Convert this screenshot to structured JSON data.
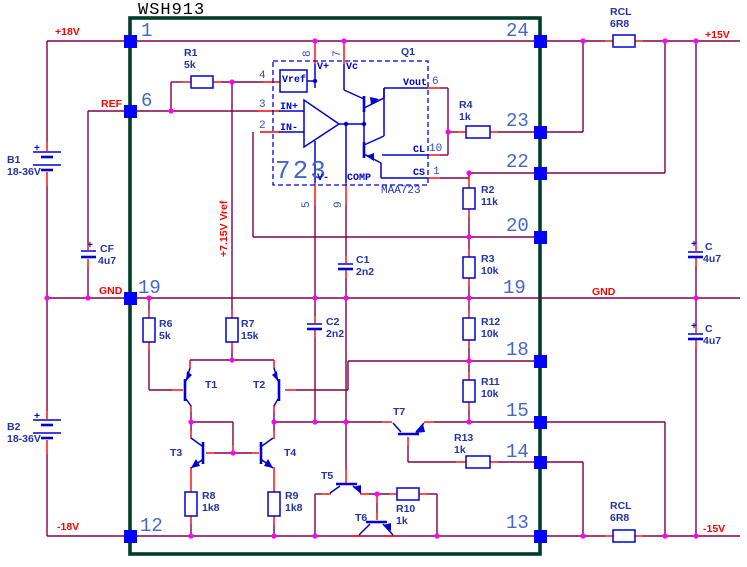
{
  "palette": {
    "wire": "#800045",
    "pin_wire": "#FF0000",
    "symbol_blue": "#0000D2",
    "pad_blue": "#0000FF",
    "junction_magenta": "#FF00FF",
    "module_border_green": "#003C28",
    "pin_number_blue": "#4466CC",
    "label_blue": "#2233AA",
    "net_label_red": "#FF0000",
    "title_black": "#000000",
    "background": "#FFFFFF"
  },
  "title": "WSH913",
  "module": {
    "pins_left": [
      "1",
      "6",
      "19",
      "12"
    ],
    "pins_right": [
      "24",
      "23",
      "22",
      "20",
      "19",
      "18",
      "15",
      "14",
      "13"
    ]
  },
  "nets": {
    "plus18": "+18V",
    "ref": "REF",
    "gnd_left": "GND",
    "minus18": "-18V",
    "plus15": "+15V",
    "gnd_right": "GND",
    "minus15": "-15V",
    "vref_rail": "+7.15V Vref"
  },
  "ic": {
    "designator": "Q1",
    "number": "723",
    "part": "MAA723",
    "terminals": {
      "vref": "Vref",
      "vplus": "V+",
      "vc": "Vc",
      "in_plus": "IN+",
      "in_minus": "IN-",
      "vout": "Vout",
      "cl": "CL",
      "cs": "CS",
      "vminus": "V-",
      "comp": "COMP"
    },
    "pin_numbers": {
      "n8": "8",
      "n7": "7",
      "n4": "4",
      "n3": "3",
      "n2": "2",
      "n6": "6",
      "n10": "10",
      "n1": "1",
      "n5": "5",
      "n9": "9"
    }
  },
  "components": {
    "b1": {
      "ref": "B1",
      "value": "18-36V",
      "plus": "+"
    },
    "b2": {
      "ref": "B2",
      "value": "18-36V",
      "plus": "+"
    },
    "cf": {
      "ref": "CF",
      "value": "4u7",
      "plus": "+"
    },
    "c_out_top": {
      "ref": "C",
      "value": "4u7",
      "plus": "+"
    },
    "c_out_bottom": {
      "ref": "C",
      "value": "4u7",
      "plus": "+"
    },
    "rcl_top": {
      "ref": "RCL",
      "value": "6R8"
    },
    "rcl_bottom": {
      "ref": "RCL",
      "value": "6R8"
    },
    "r1": {
      "ref": "R1",
      "value": "5k"
    },
    "r2": {
      "ref": "R2",
      "value": "11k"
    },
    "r3": {
      "ref": "R3",
      "value": "10k"
    },
    "r4": {
      "ref": "R4",
      "value": "1k"
    },
    "r6": {
      "ref": "R6",
      "value": "5k"
    },
    "r7": {
      "ref": "R7",
      "value": "15k"
    },
    "r8": {
      "ref": "R8",
      "value": "1k8"
    },
    "r9": {
      "ref": "R9",
      "value": "1k8"
    },
    "r10": {
      "ref": "R10",
      "value": "1k"
    },
    "r11": {
      "ref": "R11",
      "value": "10k"
    },
    "r12": {
      "ref": "R12",
      "value": "10k"
    },
    "r13": {
      "ref": "R13",
      "value": "1k"
    },
    "c1": {
      "ref": "C1",
      "value": "2n2"
    },
    "c2": {
      "ref": "C2",
      "value": "2n2"
    },
    "t1": {
      "ref": "T1"
    },
    "t2": {
      "ref": "T2"
    },
    "t3": {
      "ref": "T3"
    },
    "t4": {
      "ref": "T4"
    },
    "t5": {
      "ref": "T5"
    },
    "t6": {
      "ref": "T6"
    },
    "t7": {
      "ref": "T7"
    }
  }
}
